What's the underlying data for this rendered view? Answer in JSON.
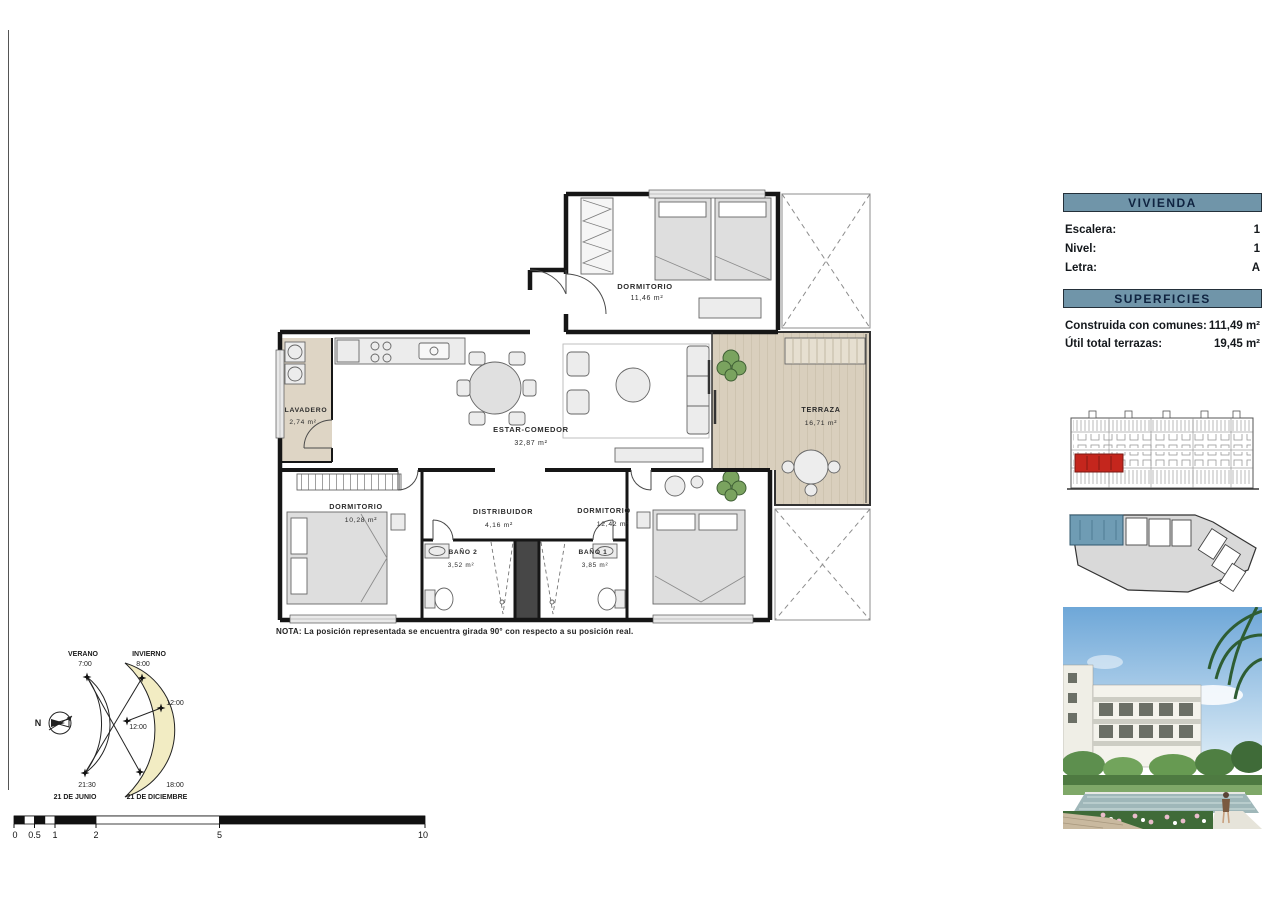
{
  "colors": {
    "header_bar": "#7095a9",
    "header_text": "#0f2340",
    "unit_highlight_red": "#c4261d",
    "unit_highlight_blue": "#6f9cb4",
    "terraza_floor": "#d9cfbd",
    "sun_crescent": "#f2ecc3",
    "walls": "#161616"
  },
  "info_panel": {
    "vivienda_title": "VIVIENDA",
    "fields": [
      {
        "label": "Escalera:",
        "value": "1"
      },
      {
        "label": "Nivel:",
        "value": "1"
      },
      {
        "label": "Letra:",
        "value": "A"
      }
    ],
    "superficies_title": "SUPERFICIES",
    "areas": [
      {
        "label": "Construida con comunes:",
        "value": "111,49 m²"
      },
      {
        "label": "Útil total terrazas:",
        "value": "19,45 m²"
      }
    ]
  },
  "plan": {
    "rooms": {
      "dormitorio_top": {
        "name": "DORMITORIO",
        "area": "11,46 m²"
      },
      "lavadero": {
        "name": "LAVADERO",
        "area": "2,74 m²"
      },
      "estar_comedor": {
        "name": "ESTAR-COMEDOR",
        "area": "32,87 m²"
      },
      "terraza": {
        "name": "TERRAZA",
        "area": "16,71 m²"
      },
      "dormitorio_left": {
        "name": "DORMITORIO",
        "area": "10,28 m²"
      },
      "distribuidor": {
        "name": "DISTRIBUIDOR",
        "area": "4,16 m²"
      },
      "dormitorio_right": {
        "name": "DORMITORIO",
        "area": "12,42 m²"
      },
      "bano_2": {
        "name": "BAÑO 2",
        "area": "3,52 m²"
      },
      "bano_1": {
        "name": "BAÑO 1",
        "area": "3,85 m²"
      }
    },
    "note": "NOTA: La posición representada se encuentra girada 90° con respecto a su posición real."
  },
  "sun_diagram": {
    "north": "N",
    "verano_label": "VERANO",
    "verano_sunrise": "7:00",
    "invierno_label": "INVIERNO",
    "invierno_sunrise": "8:00",
    "noon_invierno": "12:00",
    "noon_verano": "12:00",
    "verano_sunset": "21:30",
    "verano_date": "21 DE JUNIO",
    "invierno_sunset": "18:00",
    "invierno_date": "21 DE DICIEMBRE"
  },
  "scale_bar": {
    "labels": [
      "0",
      "0.5",
      "1",
      "2",
      "5",
      "10"
    ]
  }
}
